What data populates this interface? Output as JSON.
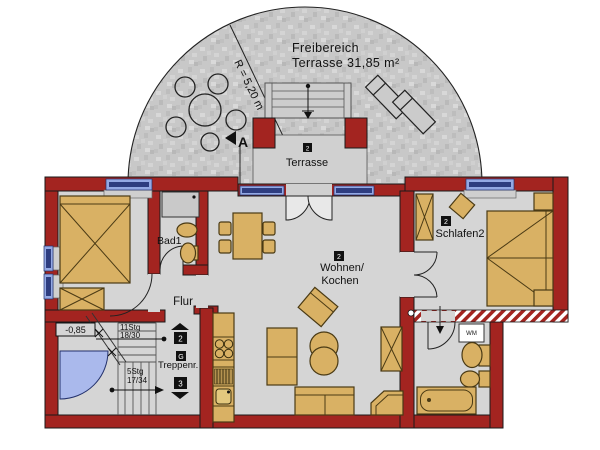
{
  "outdoor": {
    "area_label_line1": "Freibereich",
    "area_label_line2": "Terrasse 31,85 m²",
    "radius_label": "R = 5,20 m",
    "section_marker": "A"
  },
  "rooms": {
    "terrasse": {
      "badge": "2",
      "label": "Terrasse"
    },
    "wohnen_kochen": {
      "badge": "2",
      "label_line1": "Wohnen/",
      "label_line2": "Kochen"
    },
    "schlafen2": {
      "badge": "2",
      "label": "Schlafen2"
    },
    "bad1": {
      "label": "Bad1"
    },
    "flur": {
      "label": "Flur"
    },
    "treppenraum": {
      "label": "Treppenr."
    }
  },
  "stairs": {
    "elevation_label": "-0,85",
    "upper_flight_steps": "11Stg",
    "upper_flight_ratio": "18/30",
    "lower_flight_steps": "5Stg",
    "lower_flight_ratio": "17/34",
    "badge_up": "2",
    "badge_mid": "G",
    "badge_down": "3"
  },
  "appliances": {
    "washing_machine_label": "WM"
  },
  "colors": {
    "wall_red": "#a32420",
    "floor_gray": "#d5d5d5",
    "furniture_tan": "#d9b164",
    "window_light_blue": "#94a9e4",
    "window_dark_blue": "#2e3d80",
    "entry_door_blue": "#aab9ec",
    "outdoor_stipple_gray": "#c8c8c8"
  }
}
